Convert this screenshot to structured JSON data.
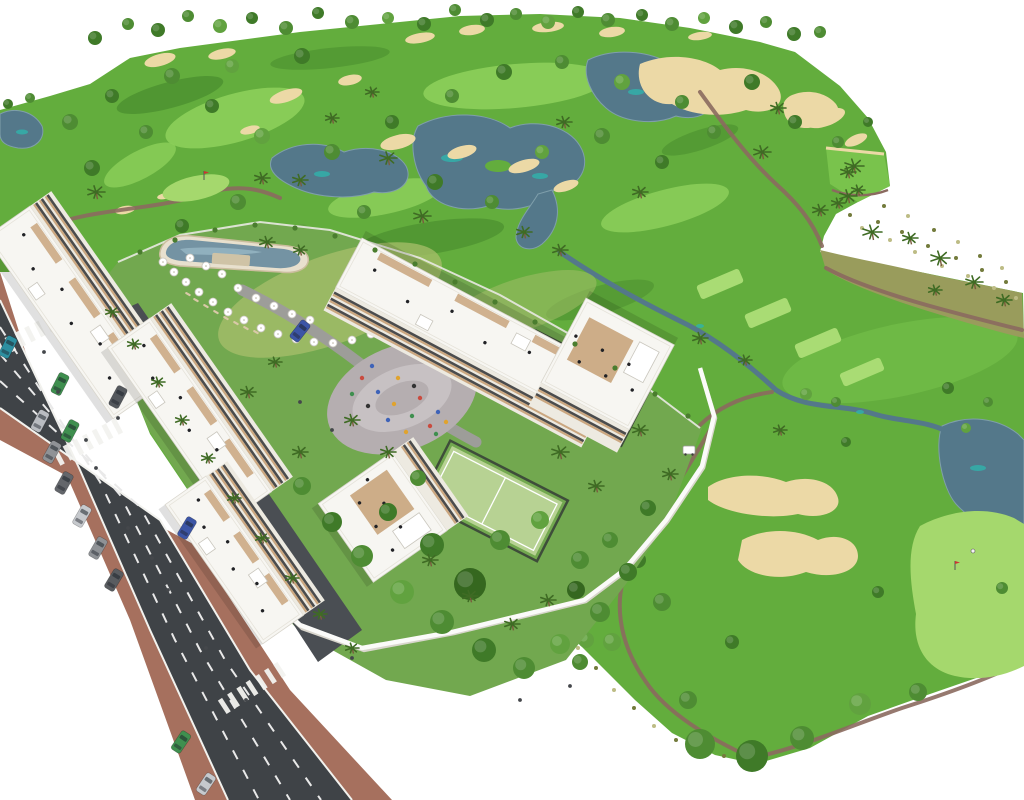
{
  "scene": {
    "type": "architectural-aerial-render",
    "labels": {
      "golf_course": "golf course with fairways, lakes and sand bunkers",
      "residential": "white apartment buildings with wood balconies and roof terraces",
      "pool": "lagoon swimming pool with sun umbrellas",
      "playground": "central plaza playground",
      "padel_courts": "fenced padel courts",
      "road": "avenue with traffic lanes, crosswalks and parked cars",
      "golfer": "golfer on putting green",
      "golf_cart": "white golf cart on path"
    }
  },
  "palette": {
    "bg": "#ffffff",
    "golf_base": "#63ad3d",
    "fairway_light": "#8ccf5a",
    "fairway_bright": "#79c34c",
    "rough_dark": "#3e7f27",
    "tee": "#a9dc74",
    "green_light": "#a5d86d",
    "scrub": "#999c5c",
    "scrub_dark": "#737b3c",
    "scrub_light": "#bdbc85",
    "lake": "#54788a",
    "lake_edge": "#7f9fab",
    "lake_teal": "#2fb3ab",
    "sand": "#ecd9a6",
    "walkway": "#8b6a5f",
    "road": "#3f4347",
    "road_line": "#e9e9e9",
    "sidewalk": "#a6705e",
    "curb": "#f2f2ee",
    "driveway": "#4a4e53",
    "inner_road": "#9d9d99",
    "resort_lawn": "#72a84f",
    "lawn_light": "#a8bf6b",
    "garden_green": "#4a7d2e",
    "wall_white": "#fbfbf9",
    "wall_shadow": "#d9d6cd",
    "building_white": "#f7f6f2",
    "facade": "#edeae1",
    "wood": "#c6a075",
    "window_dark": "#2e3033",
    "pool_deck": "#e8e0ce",
    "pool_water": "#7493a3",
    "pool_water_light": "#9cbcc9",
    "court_green": "#b7d293",
    "fence_dark": "#3e4d3a",
    "playground_gray": "#b5aeb0",
    "playground_light": "#c7c1c3",
    "palm_green": "#3f6b24",
    "trunk": "#7a5b3e",
    "flag_red": "#cc3333",
    "tree_greens": [
      "#4e8c33",
      "#3f7a28",
      "#61a23f",
      "#35671f"
    ]
  },
  "objects": {
    "ridge_trees": [
      [
        95,
        38,
        7,
        1
      ],
      [
        128,
        24,
        6,
        0
      ],
      [
        158,
        30,
        7,
        1
      ],
      [
        188,
        16,
        6,
        0
      ],
      [
        220,
        26,
        7,
        2
      ],
      [
        252,
        18,
        6,
        1
      ],
      [
        286,
        28,
        7,
        0
      ],
      [
        318,
        13,
        6,
        1
      ],
      [
        352,
        22,
        7,
        0
      ],
      [
        388,
        18,
        6,
        2
      ],
      [
        424,
        24,
        7,
        1
      ],
      [
        455,
        10,
        6,
        0
      ],
      [
        487,
        20,
        7,
        1
      ],
      [
        516,
        14,
        6,
        0
      ],
      [
        548,
        22,
        7,
        2
      ],
      [
        578,
        12,
        6,
        1
      ],
      [
        608,
        20,
        7,
        0
      ],
      [
        642,
        15,
        6,
        1
      ],
      [
        672,
        24,
        7,
        0
      ],
      [
        704,
        18,
        6,
        2
      ],
      [
        736,
        27,
        7,
        1
      ],
      [
        766,
        22,
        6,
        0
      ],
      [
        794,
        34,
        7,
        1
      ],
      [
        820,
        32,
        6,
        0
      ],
      [
        8,
        104,
        5,
        1
      ],
      [
        30,
        98,
        5,
        0
      ]
    ],
    "golf_trees": [
      [
        70,
        122,
        8,
        0
      ],
      [
        112,
        96,
        7,
        1
      ],
      [
        172,
        76,
        8,
        0
      ],
      [
        232,
        66,
        7,
        2
      ],
      [
        302,
        56,
        8,
        1
      ],
      [
        92,
        168,
        8,
        1
      ],
      [
        146,
        132,
        7,
        0
      ],
      [
        212,
        106,
        7,
        1
      ],
      [
        262,
        136,
        8,
        2
      ],
      [
        332,
        152,
        8,
        0
      ],
      [
        392,
        122,
        7,
        1
      ],
      [
        452,
        96,
        7,
        0
      ],
      [
        504,
        72,
        8,
        1
      ],
      [
        562,
        62,
        7,
        0
      ],
      [
        622,
        82,
        8,
        2
      ],
      [
        682,
        102,
        7,
        0
      ],
      [
        435,
        182,
        8,
        1
      ],
      [
        492,
        202,
        7,
        0
      ],
      [
        542,
        152,
        7,
        2
      ],
      [
        602,
        136,
        8,
        0
      ],
      [
        662,
        162,
        7,
        1
      ],
      [
        714,
        132,
        7,
        0
      ],
      [
        752,
        82,
        8,
        1
      ],
      [
        238,
        202,
        8,
        0
      ],
      [
        182,
        226,
        7,
        1
      ],
      [
        302,
        232,
        8,
        2
      ],
      [
        364,
        212,
        7,
        0
      ],
      [
        795,
        122,
        7,
        1
      ],
      [
        838,
        142,
        6,
        0
      ],
      [
        868,
        122,
        5,
        1
      ],
      [
        806,
        394,
        6,
        2
      ],
      [
        836,
        402,
        5,
        0
      ],
      [
        948,
        388,
        6,
        1
      ],
      [
        988,
        402,
        5,
        0
      ],
      [
        966,
        428,
        5,
        2
      ],
      [
        846,
        442,
        5,
        1
      ],
      [
        700,
        744,
        15,
        0
      ],
      [
        752,
        756,
        16,
        1
      ],
      [
        802,
        738,
        12,
        0
      ],
      [
        860,
        704,
        11,
        2
      ],
      [
        918,
        692,
        9,
        0
      ],
      [
        638,
        560,
        8,
        1
      ],
      [
        662,
        602,
        9,
        0
      ],
      [
        612,
        642,
        9,
        2
      ],
      [
        580,
        662,
        8,
        0
      ],
      [
        878,
        592,
        6,
        1
      ],
      [
        1002,
        588,
        6,
        0
      ],
      [
        732,
        642,
        7,
        1
      ],
      [
        688,
        700,
        9,
        0
      ],
      [
        560,
        618,
        9,
        0
      ],
      [
        586,
        640,
        8,
        2
      ]
    ],
    "golf_palms": [
      [
        96,
        192,
        9
      ],
      [
        262,
        178,
        8
      ],
      [
        388,
        158,
        9
      ],
      [
        422,
        216,
        9
      ],
      [
        524,
        232,
        8
      ],
      [
        564,
        122,
        8
      ],
      [
        762,
        152,
        9
      ],
      [
        560,
        250,
        8
      ],
      [
        640,
        192,
        8
      ],
      [
        300,
        180,
        8
      ],
      [
        332,
        118,
        7
      ],
      [
        372,
        92,
        7
      ],
      [
        778,
        108,
        8
      ],
      [
        820,
        210,
        8
      ],
      [
        854,
        166,
        10
      ],
      [
        700,
        338,
        8
      ],
      [
        745,
        360,
        7
      ],
      [
        780,
        430,
        7
      ]
    ],
    "scrub_palms": [
      [
        848,
        196,
        9
      ],
      [
        872,
        232,
        10
      ],
      [
        910,
        238,
        8
      ],
      [
        940,
        258,
        10
      ],
      [
        974,
        282,
        9
      ],
      [
        1004,
        300,
        8
      ],
      [
        935,
        290,
        7
      ],
      [
        848,
        172,
        8
      ],
      [
        858,
        190,
        7
      ],
      [
        838,
        203,
        7
      ]
    ],
    "scrub_dots": [
      [
        850,
        215,
        1
      ],
      [
        862,
        228,
        2
      ],
      [
        878,
        222,
        1
      ],
      [
        890,
        240,
        2
      ],
      [
        902,
        232,
        1
      ],
      [
        915,
        252,
        2
      ],
      [
        928,
        246,
        1
      ],
      [
        942,
        266,
        2
      ],
      [
        956,
        258,
        1
      ],
      [
        968,
        276,
        2
      ],
      [
        982,
        270,
        1
      ],
      [
        994,
        288,
        2
      ],
      [
        1006,
        282,
        1
      ],
      [
        1016,
        298,
        2
      ],
      [
        884,
        206,
        1
      ],
      [
        908,
        216,
        2
      ],
      [
        934,
        230,
        1
      ],
      [
        958,
        242,
        2
      ],
      [
        980,
        256,
        1
      ],
      [
        1002,
        268,
        2
      ],
      [
        560,
        630,
        1
      ],
      [
        578,
        648,
        2
      ],
      [
        596,
        668,
        1
      ],
      [
        614,
        690,
        2
      ],
      [
        634,
        708,
        1
      ],
      [
        654,
        726,
        2
      ],
      [
        676,
        740,
        1
      ],
      [
        700,
        750,
        2
      ],
      [
        724,
        756,
        1
      ]
    ],
    "tee_boxes": [
      [
        720,
        284,
        46,
        15,
        -23
      ],
      [
        768,
        313,
        46,
        15,
        -23
      ],
      [
        818,
        343,
        46,
        15,
        -23
      ],
      [
        862,
        372,
        44,
        14,
        -23
      ]
    ],
    "garden_trees": [
      [
        302,
        486,
        9,
        0
      ],
      [
        332,
        522,
        10,
        1
      ],
      [
        362,
        556,
        11,
        0
      ],
      [
        402,
        592,
        12,
        2
      ],
      [
        442,
        622,
        12,
        0
      ],
      [
        484,
        650,
        12,
        1
      ],
      [
        524,
        668,
        11,
        0
      ],
      [
        560,
        644,
        10,
        2
      ],
      [
        600,
        612,
        10,
        0
      ],
      [
        628,
        572,
        9,
        1
      ],
      [
        470,
        584,
        16,
        3
      ],
      [
        432,
        545,
        12,
        1
      ],
      [
        500,
        540,
        10,
        0
      ],
      [
        540,
        520,
        9,
        2
      ],
      [
        580,
        560,
        9,
        0
      ],
      [
        388,
        512,
        9,
        1
      ],
      [
        418,
        478,
        8,
        0
      ],
      [
        576,
        590,
        9,
        3
      ],
      [
        610,
        540,
        8,
        0
      ],
      [
        648,
        508,
        8,
        1
      ]
    ],
    "hedge_bushes": [
      [
        140,
        252
      ],
      [
        175,
        240
      ],
      [
        215,
        230
      ],
      [
        255,
        225
      ],
      [
        295,
        228
      ],
      [
        335,
        236
      ],
      [
        375,
        250
      ],
      [
        415,
        264
      ],
      [
        455,
        282
      ],
      [
        495,
        302
      ],
      [
        535,
        322
      ],
      [
        575,
        344
      ],
      [
        615,
        368
      ],
      [
        655,
        394
      ],
      [
        688,
        416
      ]
    ],
    "garden_palms": [
      [
        112,
        312,
        7
      ],
      [
        134,
        344,
        7
      ],
      [
        158,
        382,
        7
      ],
      [
        182,
        420,
        7
      ],
      [
        208,
        458,
        7
      ],
      [
        234,
        498,
        7
      ],
      [
        262,
        538,
        7
      ],
      [
        292,
        578,
        7
      ],
      [
        320,
        614,
        7
      ],
      [
        352,
        648,
        7
      ],
      [
        352,
        420,
        8
      ],
      [
        388,
        452,
        8
      ],
      [
        300,
        452,
        8
      ],
      [
        560,
        452,
        9
      ],
      [
        596,
        486,
        8
      ],
      [
        640,
        430,
        8
      ],
      [
        248,
        392,
        8
      ],
      [
        275,
        362,
        7
      ],
      [
        670,
        474,
        8
      ],
      [
        430,
        560,
        8
      ],
      [
        470,
        596,
        8
      ],
      [
        512,
        624,
        8
      ],
      [
        548,
        600,
        8
      ],
      [
        267,
        242,
        8
      ],
      [
        300,
        250,
        7
      ]
    ],
    "parasols": [
      [
        163,
        262
      ],
      [
        174,
        272
      ],
      [
        186,
        282
      ],
      [
        199,
        292
      ],
      [
        213,
        302
      ],
      [
        228,
        312
      ],
      [
        244,
        320
      ],
      [
        261,
        328
      ],
      [
        278,
        334
      ],
      [
        296,
        339
      ],
      [
        314,
        342
      ],
      [
        333,
        343
      ],
      [
        352,
        340
      ],
      [
        371,
        334
      ],
      [
        389,
        326
      ],
      [
        238,
        288
      ],
      [
        256,
        298
      ],
      [
        274,
        306
      ],
      [
        292,
        314
      ],
      [
        310,
        320
      ],
      [
        222,
        274
      ],
      [
        206,
        266
      ],
      [
        190,
        258
      ]
    ],
    "loungers": [
      [
        196,
        300
      ],
      [
        206,
        306
      ],
      [
        216,
        312
      ],
      [
        226,
        318
      ],
      [
        188,
        294
      ],
      [
        236,
        323
      ],
      [
        246,
        328
      ],
      [
        256,
        332
      ]
    ],
    "playground_dots": [
      [
        362,
        378,
        0
      ],
      [
        378,
        392,
        1
      ],
      [
        394,
        404,
        2
      ],
      [
        412,
        416,
        3
      ],
      [
        430,
        426,
        0
      ],
      [
        368,
        406,
        4
      ],
      [
        388,
        420,
        1
      ],
      [
        406,
        432,
        2
      ],
      [
        352,
        394,
        3
      ],
      [
        420,
        398,
        0
      ],
      [
        438,
        412,
        1
      ],
      [
        398,
        378,
        2
      ],
      [
        414,
        386,
        4
      ],
      [
        372,
        366,
        1
      ],
      [
        436,
        434,
        3
      ],
      [
        446,
        422,
        2
      ]
    ],
    "dot_colors": [
      "#c94b3f",
      "#3f63b8",
      "#e0a32e",
      "#3f8f4f",
      "#333333"
    ],
    "buildings": [
      {
        "x": 30,
        "y": 206,
        "a": 55,
        "L": 222,
        "D": 54,
        "s": -1
      },
      {
        "x": 150,
        "y": 318,
        "a": 55,
        "L": 212,
        "D": 52,
        "s": -1
      },
      {
        "x": 206,
        "y": 476,
        "a": 55,
        "L": 170,
        "D": 50,
        "s": -1
      },
      {
        "x": 392,
        "y": 452,
        "a": 55,
        "L": 96,
        "D": 90,
        "s": -1,
        "w": 1
      },
      {
        "x": 362,
        "y": 238,
        "a": 28,
        "L": 292,
        "D": 56,
        "s": 1
      },
      {
        "x": 586,
        "y": 298,
        "a": 28,
        "L": 100,
        "D": 96,
        "s": 1,
        "w": 1
      }
    ],
    "cars": [
      {
        "x": 8,
        "y": 347,
        "a": 27,
        "c": "#2d8fa0"
      },
      {
        "x": 60,
        "y": 384,
        "a": 27,
        "c": "#3f8f4f"
      },
      {
        "x": 118,
        "y": 397,
        "a": 28,
        "c": "#54585d"
      },
      {
        "x": 70,
        "y": 431,
        "a": 28,
        "c": "#3f8f4f"
      },
      {
        "x": 40,
        "y": 421,
        "a": 28,
        "c": "#b9bcc1"
      },
      {
        "x": 52,
        "y": 452,
        "a": 29,
        "c": "#8f9296"
      },
      {
        "x": 64,
        "y": 483,
        "a": 29,
        "c": "#63666b"
      },
      {
        "x": 82,
        "y": 516,
        "a": 30,
        "c": "#c6c9cd"
      },
      {
        "x": 98,
        "y": 548,
        "a": 30,
        "c": "#8f9296"
      },
      {
        "x": 114,
        "y": 580,
        "a": 31,
        "c": "#595c60"
      },
      {
        "x": 187,
        "y": 528,
        "a": 31,
        "c": "#3c55a6"
      },
      {
        "x": 181,
        "y": 742,
        "a": 34,
        "c": "#3f8f4f"
      },
      {
        "x": 206,
        "y": 784,
        "a": 34,
        "c": "#c6c9cd"
      },
      {
        "x": 300,
        "y": 331,
        "a": 38,
        "c": "#3c55a6"
      }
    ],
    "crosswalks": [
      {
        "x": 30,
        "y": 334,
        "a": 63
      },
      {
        "x": 88,
        "y": 442,
        "a": 62
      },
      {
        "x": 252,
        "y": 688,
        "a": 57
      }
    ],
    "people": [
      [
        44,
        352
      ],
      [
        58,
        392
      ],
      [
        96,
        468
      ],
      [
        128,
        528
      ],
      [
        168,
        590
      ],
      [
        206,
        648
      ],
      [
        118,
        418
      ],
      [
        86,
        440
      ],
      [
        152,
        558
      ],
      [
        246,
        700
      ],
      [
        352,
        658
      ],
      [
        300,
        402
      ],
      [
        332,
        430
      ],
      [
        520,
        700
      ],
      [
        570,
        686
      ]
    ],
    "golfer": {
      "x": 973,
      "y": 551
    },
    "golf_cart": {
      "x": 689,
      "y": 450
    },
    "flags": [
      [
        204,
        180
      ],
      [
        955,
        570
      ]
    ]
  }
}
